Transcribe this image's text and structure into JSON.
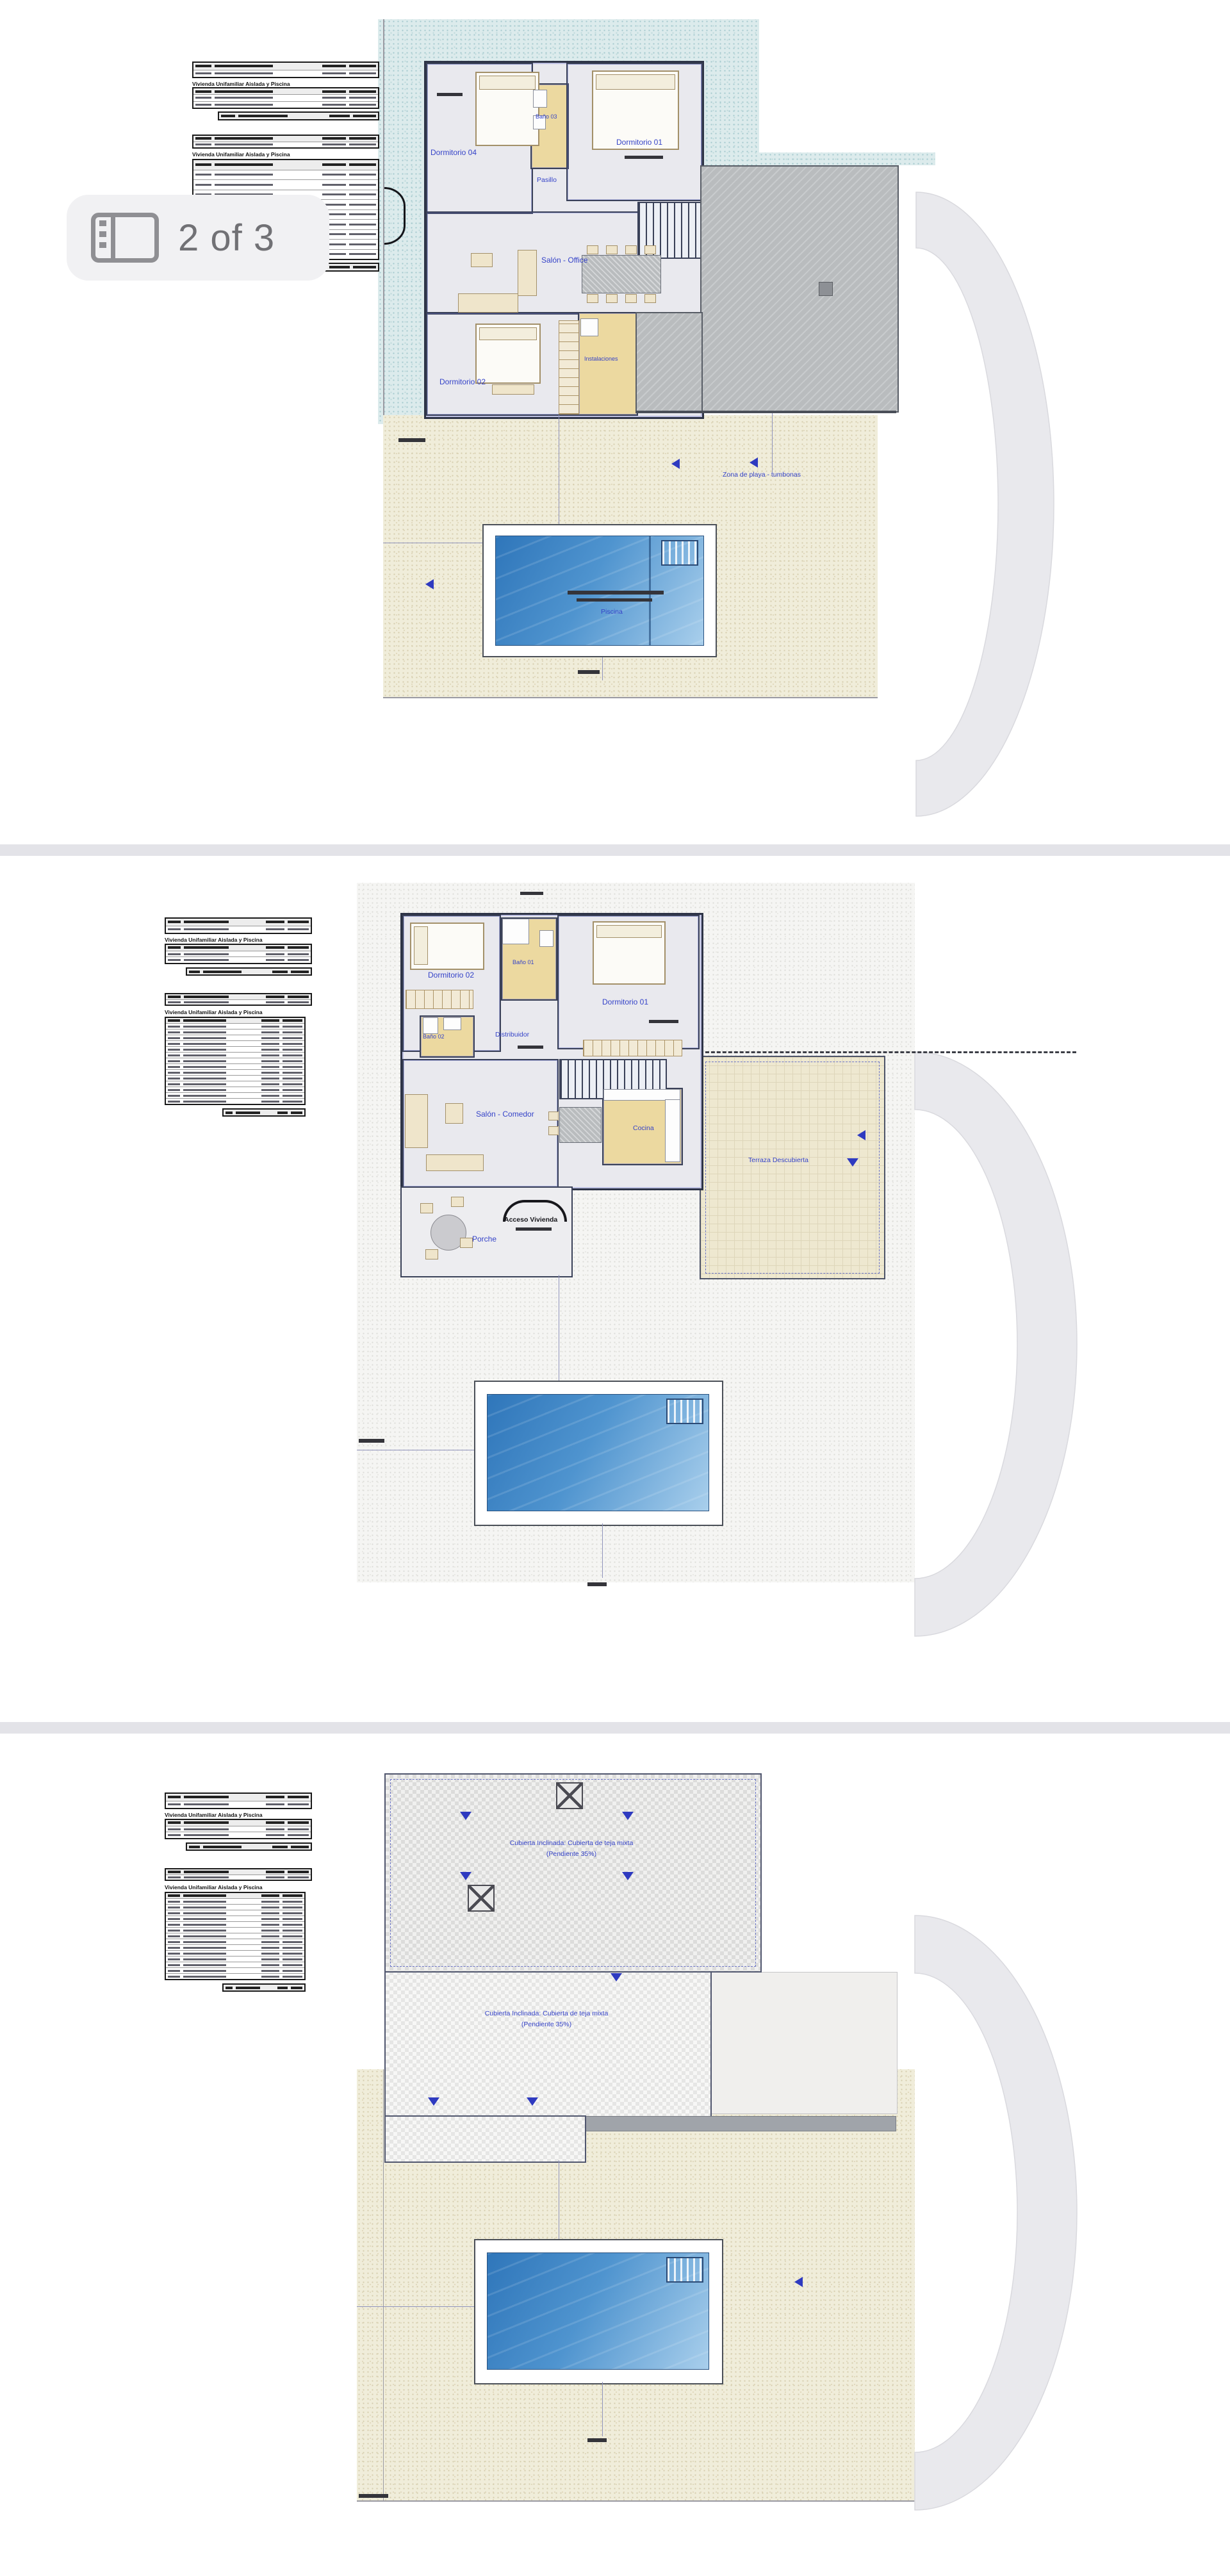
{
  "badge": {
    "label": "2 of 3",
    "icon": "gallery-icon"
  },
  "table_caption": "Vivienda Unifamiliar Aislada y Piscina",
  "colors": {
    "accent_blue": "#3543c8",
    "teal_texture": "#dcebec",
    "beige_texture": "#f0edda",
    "pool_dark": "#2f76ba",
    "pool_light": "#a9cfec",
    "arc_gray": "#e9e9ed",
    "bath_yellow": "#ecd9a0"
  },
  "plans": {
    "first_floor": {
      "rooms": {
        "dormitorio04": "Dormitorio 04",
        "bano03": "Baño 03",
        "dormitorio01": "Dormitorio 01",
        "pasillo": "Pasillo",
        "salon_office": "Salón - Office",
        "dormitorio02": "Dormitorio 02",
        "instalaciones": "Instalaciones"
      },
      "pool_label": "Piscina",
      "beach_label": "Zona de playa - tumbonas"
    },
    "ground_floor": {
      "rooms": {
        "dormitorio02": "Dormitorio 02",
        "bano01": "Baño 01",
        "dormitorio01": "Dormitorio 01",
        "bano02": "Baño 02",
        "distribuidor": "Distribuidor",
        "salon_comedor": "Salón - Comedor",
        "cocina": "Cocina",
        "porche": "Porche"
      },
      "access_label": "Acceso Vivienda",
      "terrace_label": "Terraza Descubierta"
    },
    "roof": {
      "label_line1": "Cubierta Inclinada: Cubierta de teja mixta",
      "label_line2": "(Pendiente 35%)"
    }
  }
}
